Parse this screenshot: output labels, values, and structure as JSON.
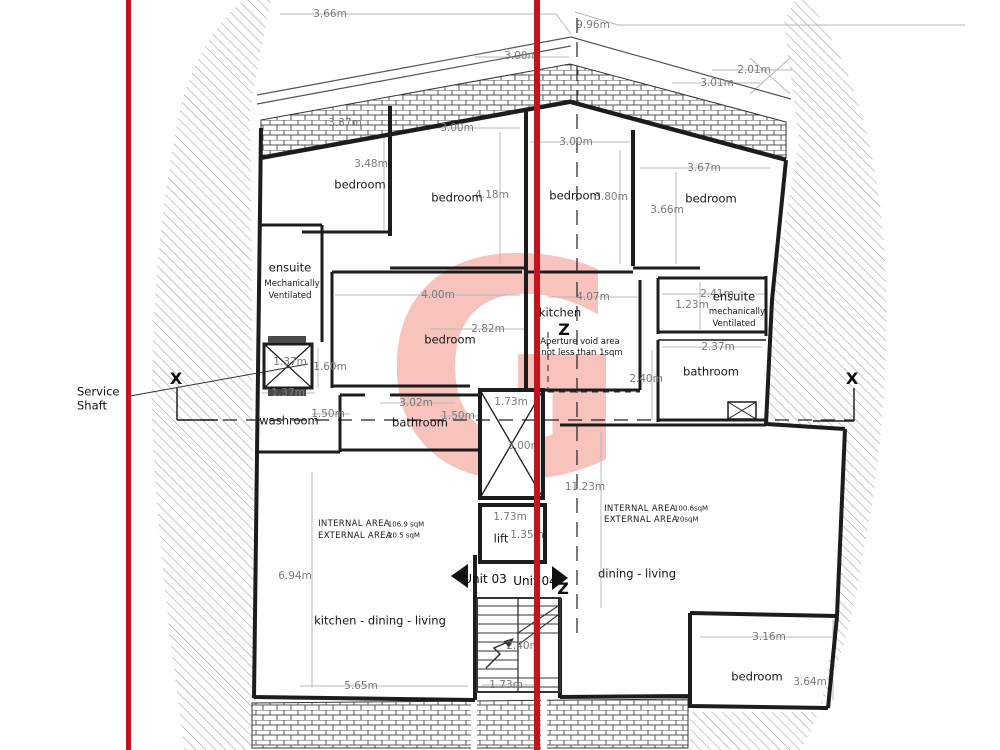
{
  "colors": {
    "section_cut_red": "#c9101f",
    "watermark_pink": "#f8c3bc",
    "wall_black": "#1c1c1c",
    "dimension_grey": "#b9b9b9",
    "dimension_text_grey": "#7a7a7a",
    "hatch_grey": "#9b9b9b"
  },
  "watermark": {
    "letter": "G"
  },
  "labels": [
    {
      "text": "3.66m",
      "x": 330,
      "y": 14,
      "cls": "dim"
    },
    {
      "text": "9.96m",
      "x": 593,
      "y": 25,
      "cls": "dim"
    },
    {
      "text": "3.00m",
      "x": 521,
      "y": 56,
      "cls": "dim"
    },
    {
      "text": "2.01m",
      "x": 754,
      "y": 70,
      "cls": "dim"
    },
    {
      "text": "3.01m",
      "x": 717,
      "y": 83,
      "cls": "dim"
    },
    {
      "text": "3.37m",
      "x": 345,
      "y": 123,
      "cls": "dim"
    },
    {
      "text": "3.00m",
      "x": 457,
      "y": 128,
      "cls": "dim"
    },
    {
      "text": "3.00m",
      "x": 576,
      "y": 142,
      "cls": "dim"
    },
    {
      "text": "3.67m",
      "x": 704,
      "y": 168,
      "cls": "dim"
    },
    {
      "text": "3.48m",
      "x": 371,
      "y": 164,
      "cls": "dim"
    },
    {
      "text": "4.18m",
      "x": 492,
      "y": 195,
      "cls": "dim"
    },
    {
      "text": "3.80m",
      "x": 611,
      "y": 197,
      "cls": "dim"
    },
    {
      "text": "3.66m",
      "x": 667,
      "y": 210,
      "cls": "dim"
    },
    {
      "text": "4.00m",
      "x": 438,
      "y": 295,
      "cls": "dim"
    },
    {
      "text": "4.07m",
      "x": 593,
      "y": 297,
      "cls": "dim"
    },
    {
      "text": "2.41m",
      "x": 717,
      "y": 294,
      "cls": "dim"
    },
    {
      "text": "1.23m",
      "x": 692,
      "y": 305,
      "cls": "dim"
    },
    {
      "text": "2.82m",
      "x": 488,
      "y": 329,
      "cls": "dim"
    },
    {
      "text": "2.37m",
      "x": 718,
      "y": 347,
      "cls": "dim"
    },
    {
      "text": "2.40m",
      "x": 646,
      "y": 379,
      "cls": "dim"
    },
    {
      "text": "1.60m",
      "x": 330,
      "y": 367,
      "cls": "dim"
    },
    {
      "text": "1.37m",
      "x": 290,
      "y": 362,
      "cls": "dim"
    },
    {
      "text": "1.37m",
      "x": 288,
      "y": 393,
      "cls": "dim"
    },
    {
      "text": "1.50m",
      "x": 328,
      "y": 414,
      "cls": "dim"
    },
    {
      "text": "3.02m",
      "x": 416,
      "y": 403,
      "cls": "dim"
    },
    {
      "text": "1.73m",
      "x": 511,
      "y": 402,
      "cls": "dim"
    },
    {
      "text": "1.50m",
      "x": 458,
      "y": 416,
      "cls": "dim"
    },
    {
      "text": "3.00m",
      "x": 524,
      "y": 446,
      "cls": "dim"
    },
    {
      "text": "11.23m",
      "x": 585,
      "y": 487,
      "cls": "dim"
    },
    {
      "text": "1.73m",
      "x": 510,
      "y": 517,
      "cls": "dim"
    },
    {
      "text": "1.35m",
      "x": 527,
      "y": 535,
      "cls": "dim"
    },
    {
      "text": "6.94m",
      "x": 295,
      "y": 576,
      "cls": "dim"
    },
    {
      "text": "2.40m",
      "x": 523,
      "y": 646,
      "cls": "dim"
    },
    {
      "text": "3.16m",
      "x": 769,
      "y": 637,
      "cls": "dim"
    },
    {
      "text": "3.64m",
      "x": 810,
      "y": 682,
      "cls": "dim"
    },
    {
      "text": "5.65m",
      "x": 361,
      "y": 686,
      "cls": "dim"
    },
    {
      "text": "1.73m",
      "x": 506,
      "y": 685,
      "cls": "dim"
    },
    {
      "text": "bedroom",
      "x": 360,
      "y": 185,
      "cls": "room"
    },
    {
      "text": "bedroom",
      "x": 457,
      "y": 198,
      "cls": "room"
    },
    {
      "text": "bedroom",
      "x": 575,
      "y": 196,
      "cls": "room"
    },
    {
      "text": "bedroom",
      "x": 711,
      "y": 199,
      "cls": "room"
    },
    {
      "text": "ensuite",
      "x": 290,
      "y": 268,
      "cls": "room"
    },
    {
      "text": "Mechanically",
      "x": 292,
      "y": 284,
      "cls": "small"
    },
    {
      "text": "Ventilated",
      "x": 290,
      "y": 296,
      "cls": "small"
    },
    {
      "text": "ensuite",
      "x": 734,
      "y": 297,
      "cls": "room"
    },
    {
      "text": "mechanically",
      "x": 737,
      "y": 312,
      "cls": "small"
    },
    {
      "text": "Ventilated",
      "x": 734,
      "y": 324,
      "cls": "small"
    },
    {
      "text": "kitchen",
      "x": 560,
      "y": 313,
      "cls": "room"
    },
    {
      "text": "bedroom",
      "x": 450,
      "y": 340,
      "cls": "room"
    },
    {
      "text": "Aperture void area",
      "x": 580,
      "y": 342,
      "cls": "small"
    },
    {
      "text": "not less than 1sqm",
      "x": 582,
      "y": 353,
      "cls": "small"
    },
    {
      "text": "bathroom",
      "x": 711,
      "y": 372,
      "cls": "room"
    },
    {
      "text": "washroom",
      "x": 289,
      "y": 421,
      "cls": "room"
    },
    {
      "text": "bathroom",
      "x": 420,
      "y": 423,
      "cls": "room"
    },
    {
      "text": "lift",
      "x": 501,
      "y": 539,
      "cls": "room"
    },
    {
      "text": "dining - living",
      "x": 637,
      "y": 574,
      "cls": "room"
    },
    {
      "text": "kitchen - dining - living",
      "x": 380,
      "y": 621,
      "cls": "room"
    },
    {
      "text": "bedroom",
      "x": 757,
      "y": 677,
      "cls": "room"
    },
    {
      "text": "INTERNAL AREA",
      "x": 354,
      "y": 524,
      "cls": "areahead"
    },
    {
      "text": "106.9 sqM",
      "x": 406,
      "y": 525,
      "cls": "areaval"
    },
    {
      "text": "EXTERNAL AREA",
      "x": 355,
      "y": 536,
      "cls": "areahead"
    },
    {
      "text": "20.5 sqM",
      "x": 404,
      "y": 536,
      "cls": "areaval"
    },
    {
      "text": "INTERNAL AREA",
      "x": 640,
      "y": 509,
      "cls": "areahead"
    },
    {
      "text": "100.6sqM",
      "x": 691,
      "y": 509,
      "cls": "areaval"
    },
    {
      "text": "EXTERNAL AREA",
      "x": 641,
      "y": 520,
      "cls": "areahead"
    },
    {
      "text": "20sqM",
      "x": 687,
      "y": 520,
      "cls": "areaval"
    },
    {
      "text": "X",
      "x": 176,
      "y": 379,
      "cls": "marker",
      "name": "section-marker-x-left"
    },
    {
      "text": "X",
      "x": 852,
      "y": 379,
      "cls": "marker",
      "name": "section-marker-x-right"
    },
    {
      "text": "Z",
      "x": 564,
      "y": 330,
      "cls": "marker",
      "name": "section-marker-z-top"
    },
    {
      "text": "Z",
      "x": 563,
      "y": 589,
      "cls": "marker",
      "name": "section-marker-z-bottom"
    },
    {
      "text": "Unit 03",
      "x": 485,
      "y": 579,
      "cls": "unit",
      "name": "unit-03-label"
    },
    {
      "text": "Unit 04",
      "x": 535,
      "y": 581,
      "cls": "unit",
      "name": "unit-04-label"
    },
    {
      "text": "Service",
      "x": 77,
      "y": 392,
      "cls": "shaft",
      "name": "service-shaft-label"
    },
    {
      "text": "Shaft",
      "x": 77,
      "y": 406,
      "cls": "shaft",
      "name": "service-shaft-label"
    }
  ]
}
